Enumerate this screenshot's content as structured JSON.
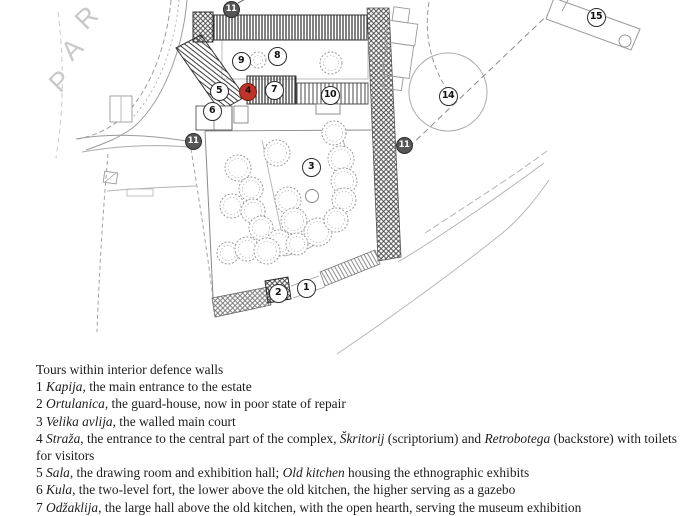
{
  "map": {
    "par_letters": [
      "P",
      "A",
      "R"
    ],
    "markers": [
      {
        "n": "11",
        "x": 231,
        "y": 9,
        "style": "filled"
      },
      {
        "n": "15",
        "x": 596,
        "y": 17,
        "style": "open"
      },
      {
        "n": "9",
        "x": 241,
        "y": 61,
        "style": "open"
      },
      {
        "n": "8",
        "x": 277,
        "y": 56,
        "style": "open"
      },
      {
        "n": "5",
        "x": 219,
        "y": 91,
        "style": "open"
      },
      {
        "n": "4",
        "x": 248,
        "y": 92,
        "style": "red"
      },
      {
        "n": "7",
        "x": 274,
        "y": 90,
        "style": "open"
      },
      {
        "n": "10",
        "x": 330,
        "y": 95,
        "style": "open"
      },
      {
        "n": "6",
        "x": 212,
        "y": 111,
        "style": "open"
      },
      {
        "n": "11",
        "x": 193,
        "y": 141,
        "style": "filled"
      },
      {
        "n": "11",
        "x": 404,
        "y": 145,
        "style": "filled"
      },
      {
        "n": "14",
        "x": 448,
        "y": 96,
        "style": "open"
      },
      {
        "n": "3",
        "x": 311,
        "y": 167,
        "style": "open"
      },
      {
        "n": "2",
        "x": 278,
        "y": 293,
        "style": "open"
      },
      {
        "n": "1",
        "x": 306,
        "y": 288,
        "style": "open"
      }
    ],
    "trees": [
      {
        "x": 258,
        "y": 60,
        "r": 8
      },
      {
        "x": 331,
        "y": 63,
        "r": 11
      },
      {
        "x": 334,
        "y": 133,
        "r": 12
      },
      {
        "x": 341,
        "y": 159,
        "r": 13
      },
      {
        "x": 344,
        "y": 181,
        "r": 13
      },
      {
        "x": 344,
        "y": 200,
        "r": 12
      },
      {
        "x": 238,
        "y": 168,
        "r": 13
      },
      {
        "x": 277,
        "y": 153,
        "r": 13
      },
      {
        "x": 251,
        "y": 189,
        "r": 12
      },
      {
        "x": 232,
        "y": 206,
        "r": 12
      },
      {
        "x": 253,
        "y": 211,
        "r": 12
      },
      {
        "x": 288,
        "y": 200,
        "r": 13
      },
      {
        "x": 261,
        "y": 228,
        "r": 12
      },
      {
        "x": 294,
        "y": 221,
        "r": 13
      },
      {
        "x": 279,
        "y": 243,
        "r": 13
      },
      {
        "x": 318,
        "y": 232,
        "r": 14
      },
      {
        "x": 336,
        "y": 220,
        "r": 12
      },
      {
        "x": 228,
        "y": 253,
        "r": 11
      },
      {
        "x": 247,
        "y": 249,
        "r": 12
      },
      {
        "x": 267,
        "y": 251,
        "r": 13
      },
      {
        "x": 297,
        "y": 244,
        "r": 11
      }
    ]
  },
  "legend": {
    "title": "Tours within interior defence walls",
    "entries": [
      {
        "num": "1",
        "segments": [
          {
            "t": "Kapija",
            "i": true
          },
          {
            "t": ", the main entrance to the estate",
            "i": false
          }
        ]
      },
      {
        "num": "2",
        "segments": [
          {
            "t": "Ortulanica",
            "i": true
          },
          {
            "t": ", the guard-house, now in poor state of repair",
            "i": false
          }
        ]
      },
      {
        "num": "3",
        "segments": [
          {
            "t": "Velika avlija",
            "i": true
          },
          {
            "t": ", the walled main court",
            "i": false
          }
        ]
      },
      {
        "num": "4",
        "segments": [
          {
            "t": "Straža",
            "i": true
          },
          {
            "t": ", the entrance to the central part of the complex, ",
            "i": false
          },
          {
            "t": "Škritorij",
            "i": true
          },
          {
            "t": " (scriptorium) and ",
            "i": false
          },
          {
            "t": "Retrobotega",
            "i": true
          },
          {
            "t": " (backstore) with toilets for visitors",
            "i": false
          }
        ]
      },
      {
        "num": "5",
        "segments": [
          {
            "t": "Sala",
            "i": true
          },
          {
            "t": ", the drawing room and exhibition hall; ",
            "i": false
          },
          {
            "t": "Old kitchen",
            "i": true
          },
          {
            "t": " housing the ethnographic exhibits",
            "i": false
          }
        ]
      },
      {
        "num": "6",
        "segments": [
          {
            "t": "Kula",
            "i": true
          },
          {
            "t": ", the two-level fort, the lower above the old kitchen, the higher serving as a gazebo",
            "i": false
          }
        ]
      },
      {
        "num": "7",
        "segments": [
          {
            "t": "Odžaklija",
            "i": true
          },
          {
            "t": ", the large hall above the old kitchen, with the open hearth, serving the museum exhibition",
            "i": false
          }
        ]
      }
    ]
  }
}
